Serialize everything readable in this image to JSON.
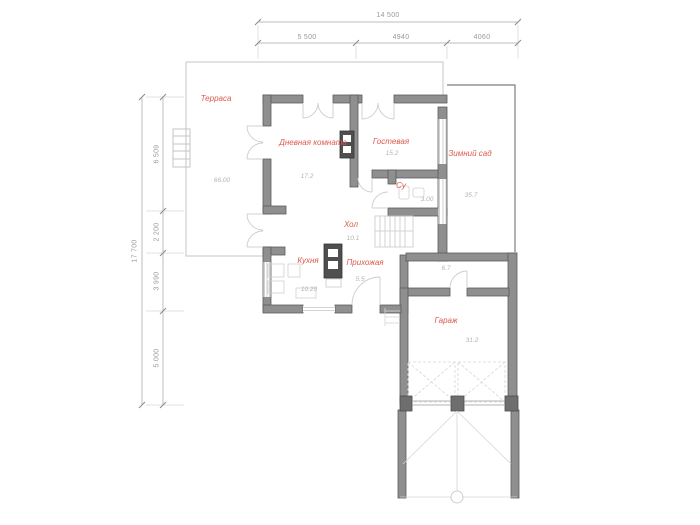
{
  "dimensions": {
    "horizontal": {
      "overall": "14 500",
      "seg1": "5 500",
      "seg2": "4940",
      "seg3": "4060"
    },
    "vertical": {
      "overall": "17 700",
      "seg1": "6 509",
      "seg2": "2 200",
      "seg3": "3 990",
      "seg4": "5 000"
    }
  },
  "rooms": {
    "terrace": {
      "name": "Терраса",
      "area": "66.00"
    },
    "living_room": {
      "name": "Дневная комната",
      "area": "17.2"
    },
    "guest_room": {
      "name": "Гостевая",
      "area": "15.2"
    },
    "winter_garden": {
      "name": "Зимний сад",
      "area": "35.7"
    },
    "bathroom": {
      "name": "Су",
      "area": "3.00"
    },
    "hall": {
      "name": "Хол",
      "area": "10.1"
    },
    "kitchen": {
      "name": "Кухня",
      "area": "10.20"
    },
    "entryway": {
      "name": "Прихожая",
      "area": "5.5"
    },
    "corridor": {
      "area": "6.7"
    },
    "garage": {
      "name": "Гараж",
      "area": "31.2"
    }
  },
  "colors": {
    "wall_fill": "#8f8f8f",
    "wall_outline": "#5c5c5c",
    "room_label": "#dc5a4d",
    "area_text": "#b3b3b3",
    "dimension_text": "#9a9a9a",
    "thin_line": "#c4c4c4"
  }
}
